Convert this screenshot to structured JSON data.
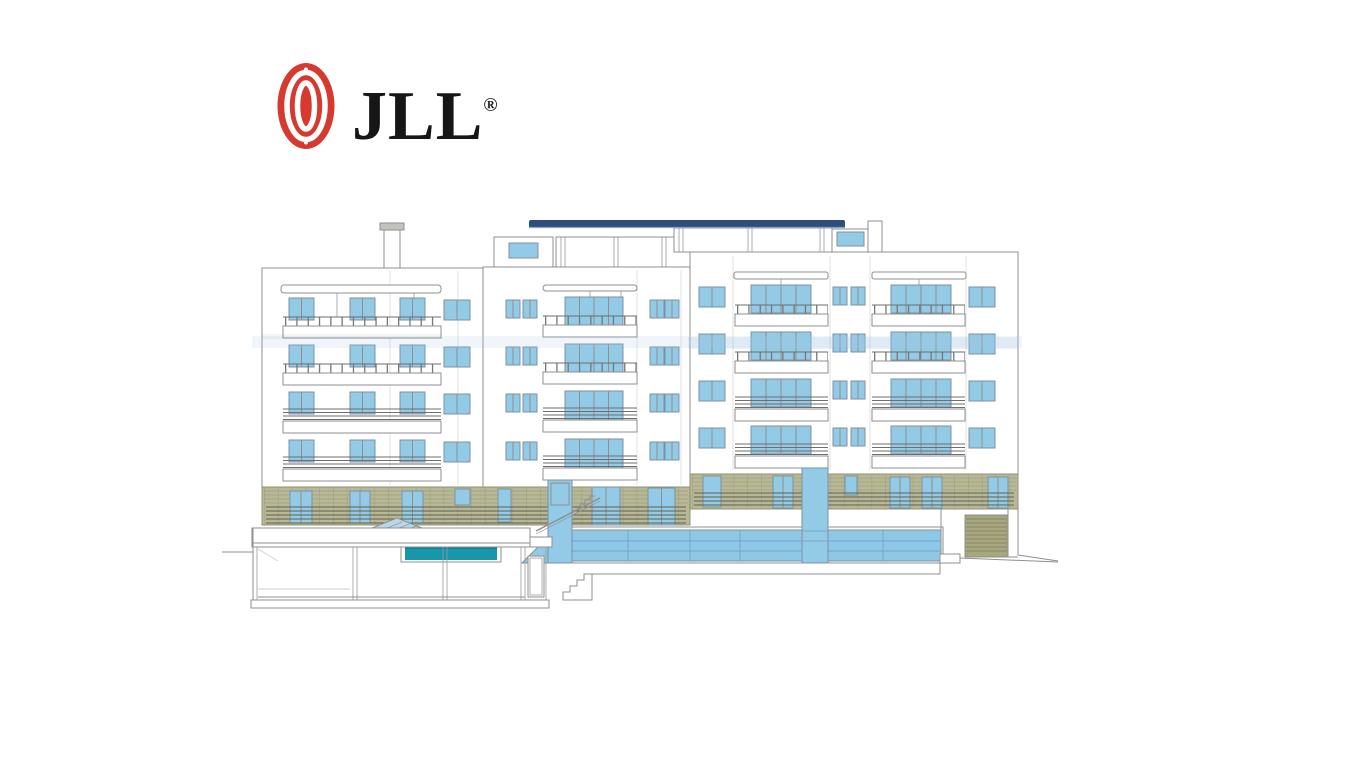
{
  "logo": {
    "brand": "JLL",
    "registered": "®",
    "globe_color": "#d63a2e",
    "text_color": "#161616"
  },
  "drawing": {
    "kind": "architectural-front-elevation",
    "subject": "five-storey apartment building with balconies, roof canopy, ground-floor cladding, glass lobby, swimming pool and basement section",
    "colors": {
      "window_blue": "#93cbe6",
      "roof_navy": "#2e4d7d",
      "roof_highlight": "#7fa6c9",
      "pool_teal": "#1697ac",
      "pool_lip": "#0d7f95",
      "cladding_olive": "#b8b896",
      "cladding_edge": "#90916f",
      "garage_olive": "#a6a77e",
      "skylight_blue": "#b9d7ec",
      "line_gray": "#8f8f8f",
      "chimney_cap": "#c2c2ba"
    },
    "elements": [
      "roof-canopy",
      "chimney",
      "penthouse-left",
      "penthouse-right",
      "left-wing",
      "center-wing",
      "right-wing",
      "balconies",
      "ground-floor-cladding",
      "skylight-pyramid",
      "swimming-pool",
      "pool-house-section",
      "stair-tower",
      "elevator-tower",
      "glass-facade",
      "garage-door",
      "exterior-stairs",
      "ground-line"
    ]
  }
}
